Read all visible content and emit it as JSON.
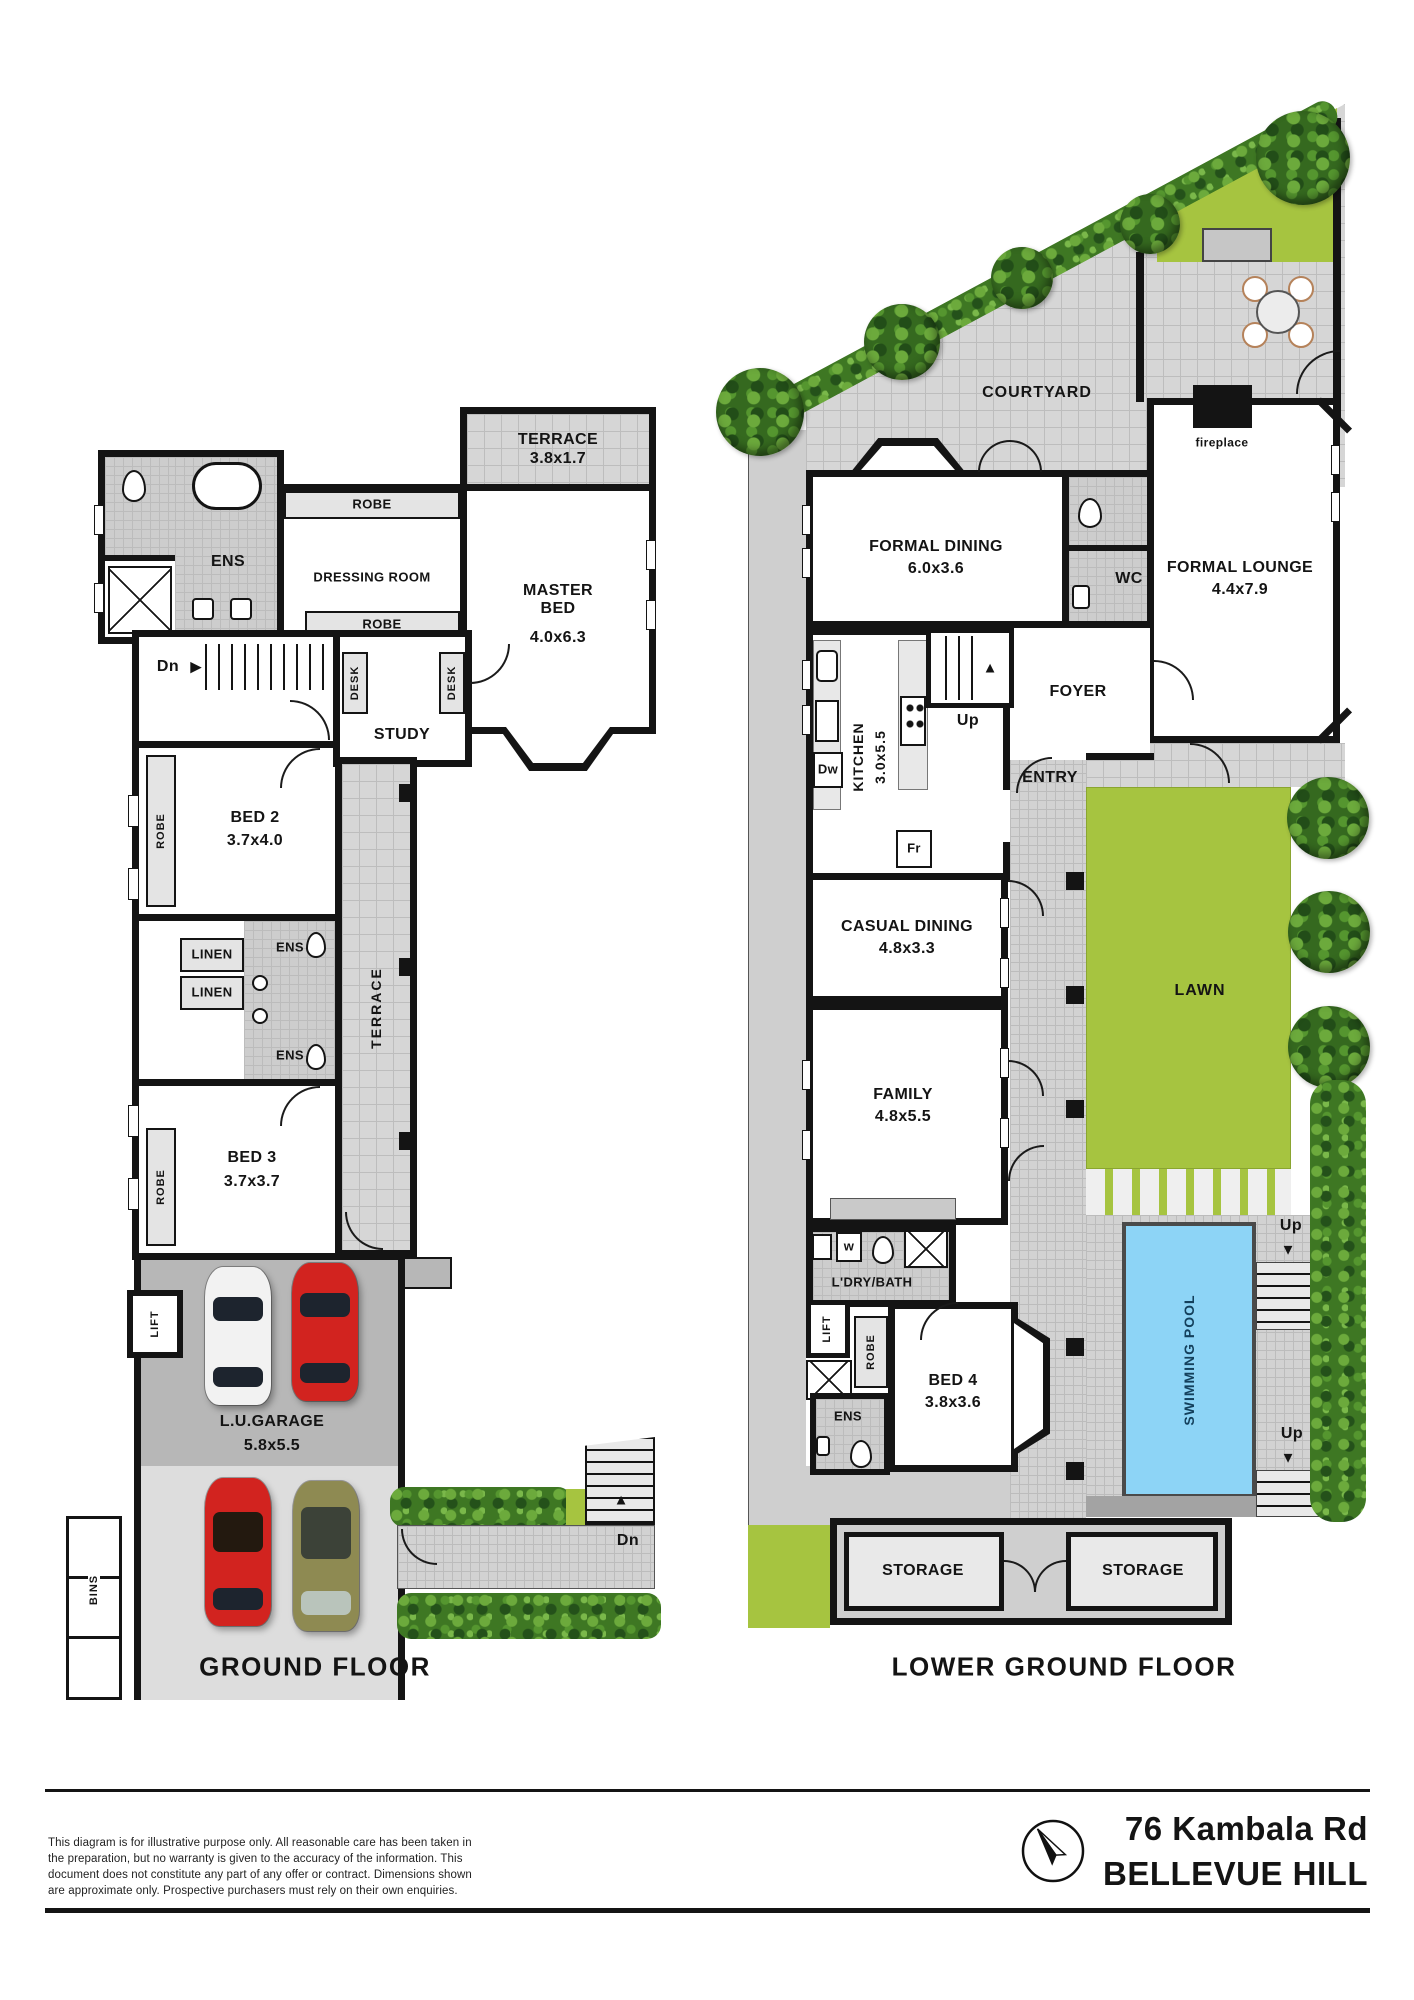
{
  "icons": {
    "up_arrow": "▲",
    "down_arrow": "▼",
    "right_arrow": "▶"
  },
  "colors": {
    "wall": "#141414",
    "tile": "#d6d6d6",
    "walkway": "#cfcfcf",
    "lawn": "#a6c440",
    "pool": "#8dd4f6",
    "hedge": "#3e7723",
    "garage_floor": "#b7b7b7",
    "driveway": "#dddddd",
    "car_red": "#d2231f",
    "car_white": "#f2f2f2",
    "car_olive": "#8e8a52"
  },
  "ground": {
    "title": "GROUND FLOOR",
    "rooms": {
      "terrace_top": {
        "name": "TERRACE",
        "dims": "3.8x1.7"
      },
      "robe_top": {
        "name": "ROBE"
      },
      "dressing": {
        "name": "DRESSING ROOM"
      },
      "robe_mid": {
        "name": "ROBE"
      },
      "ens_master": {
        "name": "ENS"
      },
      "master": {
        "name": "MASTER BED",
        "dims": "4.0x6.3"
      },
      "stairs_dn": {
        "name": "Dn"
      },
      "desk_left": {
        "name": "DESK"
      },
      "desk_right": {
        "name": "DESK"
      },
      "study": {
        "name": "STUDY"
      },
      "bed2": {
        "name": "BED 2",
        "dims": "3.7x4.0"
      },
      "robe2": {
        "name": "ROBE"
      },
      "linen1": {
        "name": "LINEN"
      },
      "linen2": {
        "name": "LINEN"
      },
      "ens_upper": {
        "name": "ENS"
      },
      "ens_lower": {
        "name": "ENS"
      },
      "terrace_side": {
        "name": "TERRACE"
      },
      "bed3": {
        "name": "BED 3",
        "dims": "3.7x3.7"
      },
      "robe3": {
        "name": "ROBE"
      },
      "lift": {
        "name": "LIFT"
      },
      "garage": {
        "name": "L.U.GARAGE",
        "dims": "5.8x5.5"
      },
      "bins": {
        "name": "BINS"
      },
      "stairs_dn_ext": {
        "name": "Dn"
      }
    }
  },
  "lower": {
    "title": "LOWER GROUND FLOOR",
    "rooms": {
      "courtyard": {
        "name": "COURTYARD"
      },
      "fireplace": {
        "name": "fireplace"
      },
      "formal_dining": {
        "name": "FORMAL DINING",
        "dims": "6.0x3.6"
      },
      "wc": {
        "name": "WC"
      },
      "formal_lounge": {
        "name": "FORMAL LOUNGE",
        "dims": "4.4x7.9"
      },
      "stairs_up": {
        "name": "Up"
      },
      "foyer": {
        "name": "FOYER"
      },
      "kitchen": {
        "name": "KITCHEN",
        "dims": "3.0x5.5"
      },
      "dishwasher": {
        "name": "Dw"
      },
      "fridge": {
        "name": "Fr"
      },
      "entry": {
        "name": "ENTRY"
      },
      "casual_dining": {
        "name": "CASUAL DINING",
        "dims": "4.8x3.3"
      },
      "family": {
        "name": "FAMILY",
        "dims": "4.8x5.5"
      },
      "laundry_bath": {
        "name": "L'DRY/BATH"
      },
      "washer": {
        "name": "w"
      },
      "lift": {
        "name": "LIFT"
      },
      "robe": {
        "name": "ROBE"
      },
      "bed4": {
        "name": "BED 4",
        "dims": "3.8x3.6"
      },
      "ens": {
        "name": "ENS"
      },
      "lawn": {
        "name": "LAWN"
      },
      "swimming_pool": {
        "name": "SWIMMING POOL"
      },
      "stairs_up_pool_top": {
        "name": "Up"
      },
      "stairs_up_pool_bottom": {
        "name": "Up"
      },
      "storage1": {
        "name": "STORAGE"
      },
      "storage2": {
        "name": "STORAGE"
      }
    }
  },
  "footer": {
    "disclaimer": [
      "This diagram is for illustrative purpose only. All reasonable care has been taken in",
      "the preparation, but no warranty is given to the accuracy of the information. This",
      "document does not constitute any part of any offer or contract. Dimensions shown",
      "are approximate only. Prospective purchasers must rely on their own enquiries."
    ],
    "address_line1": "76 Kambala Rd",
    "address_line2": "BELLEVUE HILL"
  }
}
